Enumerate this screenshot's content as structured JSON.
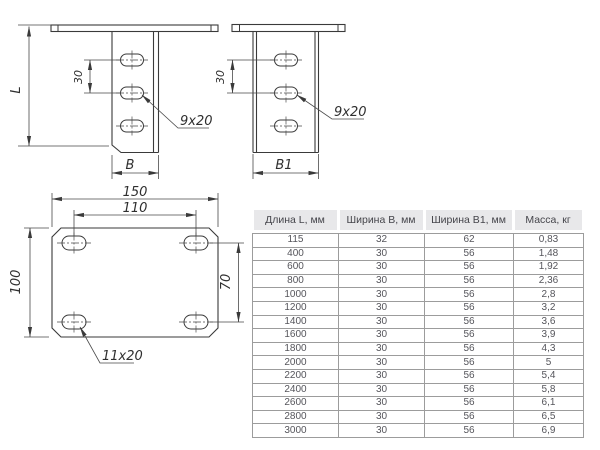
{
  "drawings": {
    "side_view_b": {
      "length_label": "L",
      "slot_spacing": "30",
      "slot_size": "9x20",
      "width_label": "B"
    },
    "side_view_b1": {
      "slot_spacing": "30",
      "slot_size": "9x20",
      "width_label": "B1"
    },
    "plan_view": {
      "overall_width": "150",
      "hole_spacing_x": "110",
      "overall_height": "100",
      "hole_spacing_y": "70",
      "slot_size": "11x20"
    }
  },
  "table": {
    "columns": [
      "Длина L, мм",
      "Ширина B, мм",
      "Ширина B1, мм",
      "Масса, кг"
    ],
    "rows": [
      [
        "115",
        "32",
        "62",
        "0,83"
      ],
      [
        "400",
        "30",
        "56",
        "1,48"
      ],
      [
        "600",
        "30",
        "56",
        "1,92"
      ],
      [
        "800",
        "30",
        "56",
        "2,36"
      ],
      [
        "1000",
        "30",
        "56",
        "2,8"
      ],
      [
        "1200",
        "30",
        "56",
        "3,2"
      ],
      [
        "1400",
        "30",
        "56",
        "3,6"
      ],
      [
        "1600",
        "30",
        "56",
        "3,9"
      ],
      [
        "1800",
        "30",
        "56",
        "4,3"
      ],
      [
        "2000",
        "30",
        "56",
        "5"
      ],
      [
        "2200",
        "30",
        "56",
        "5,4"
      ],
      [
        "2400",
        "30",
        "56",
        "5,8"
      ],
      [
        "2600",
        "30",
        "56",
        "6,1"
      ],
      [
        "2800",
        "30",
        "56",
        "6,5"
      ],
      [
        "3000",
        "30",
        "56",
        "6,9"
      ]
    ]
  },
  "colors": {
    "line": "#3a3a3a",
    "table_header_bg": "#e8e8ea",
    "table_border": "#9c9c9c"
  }
}
